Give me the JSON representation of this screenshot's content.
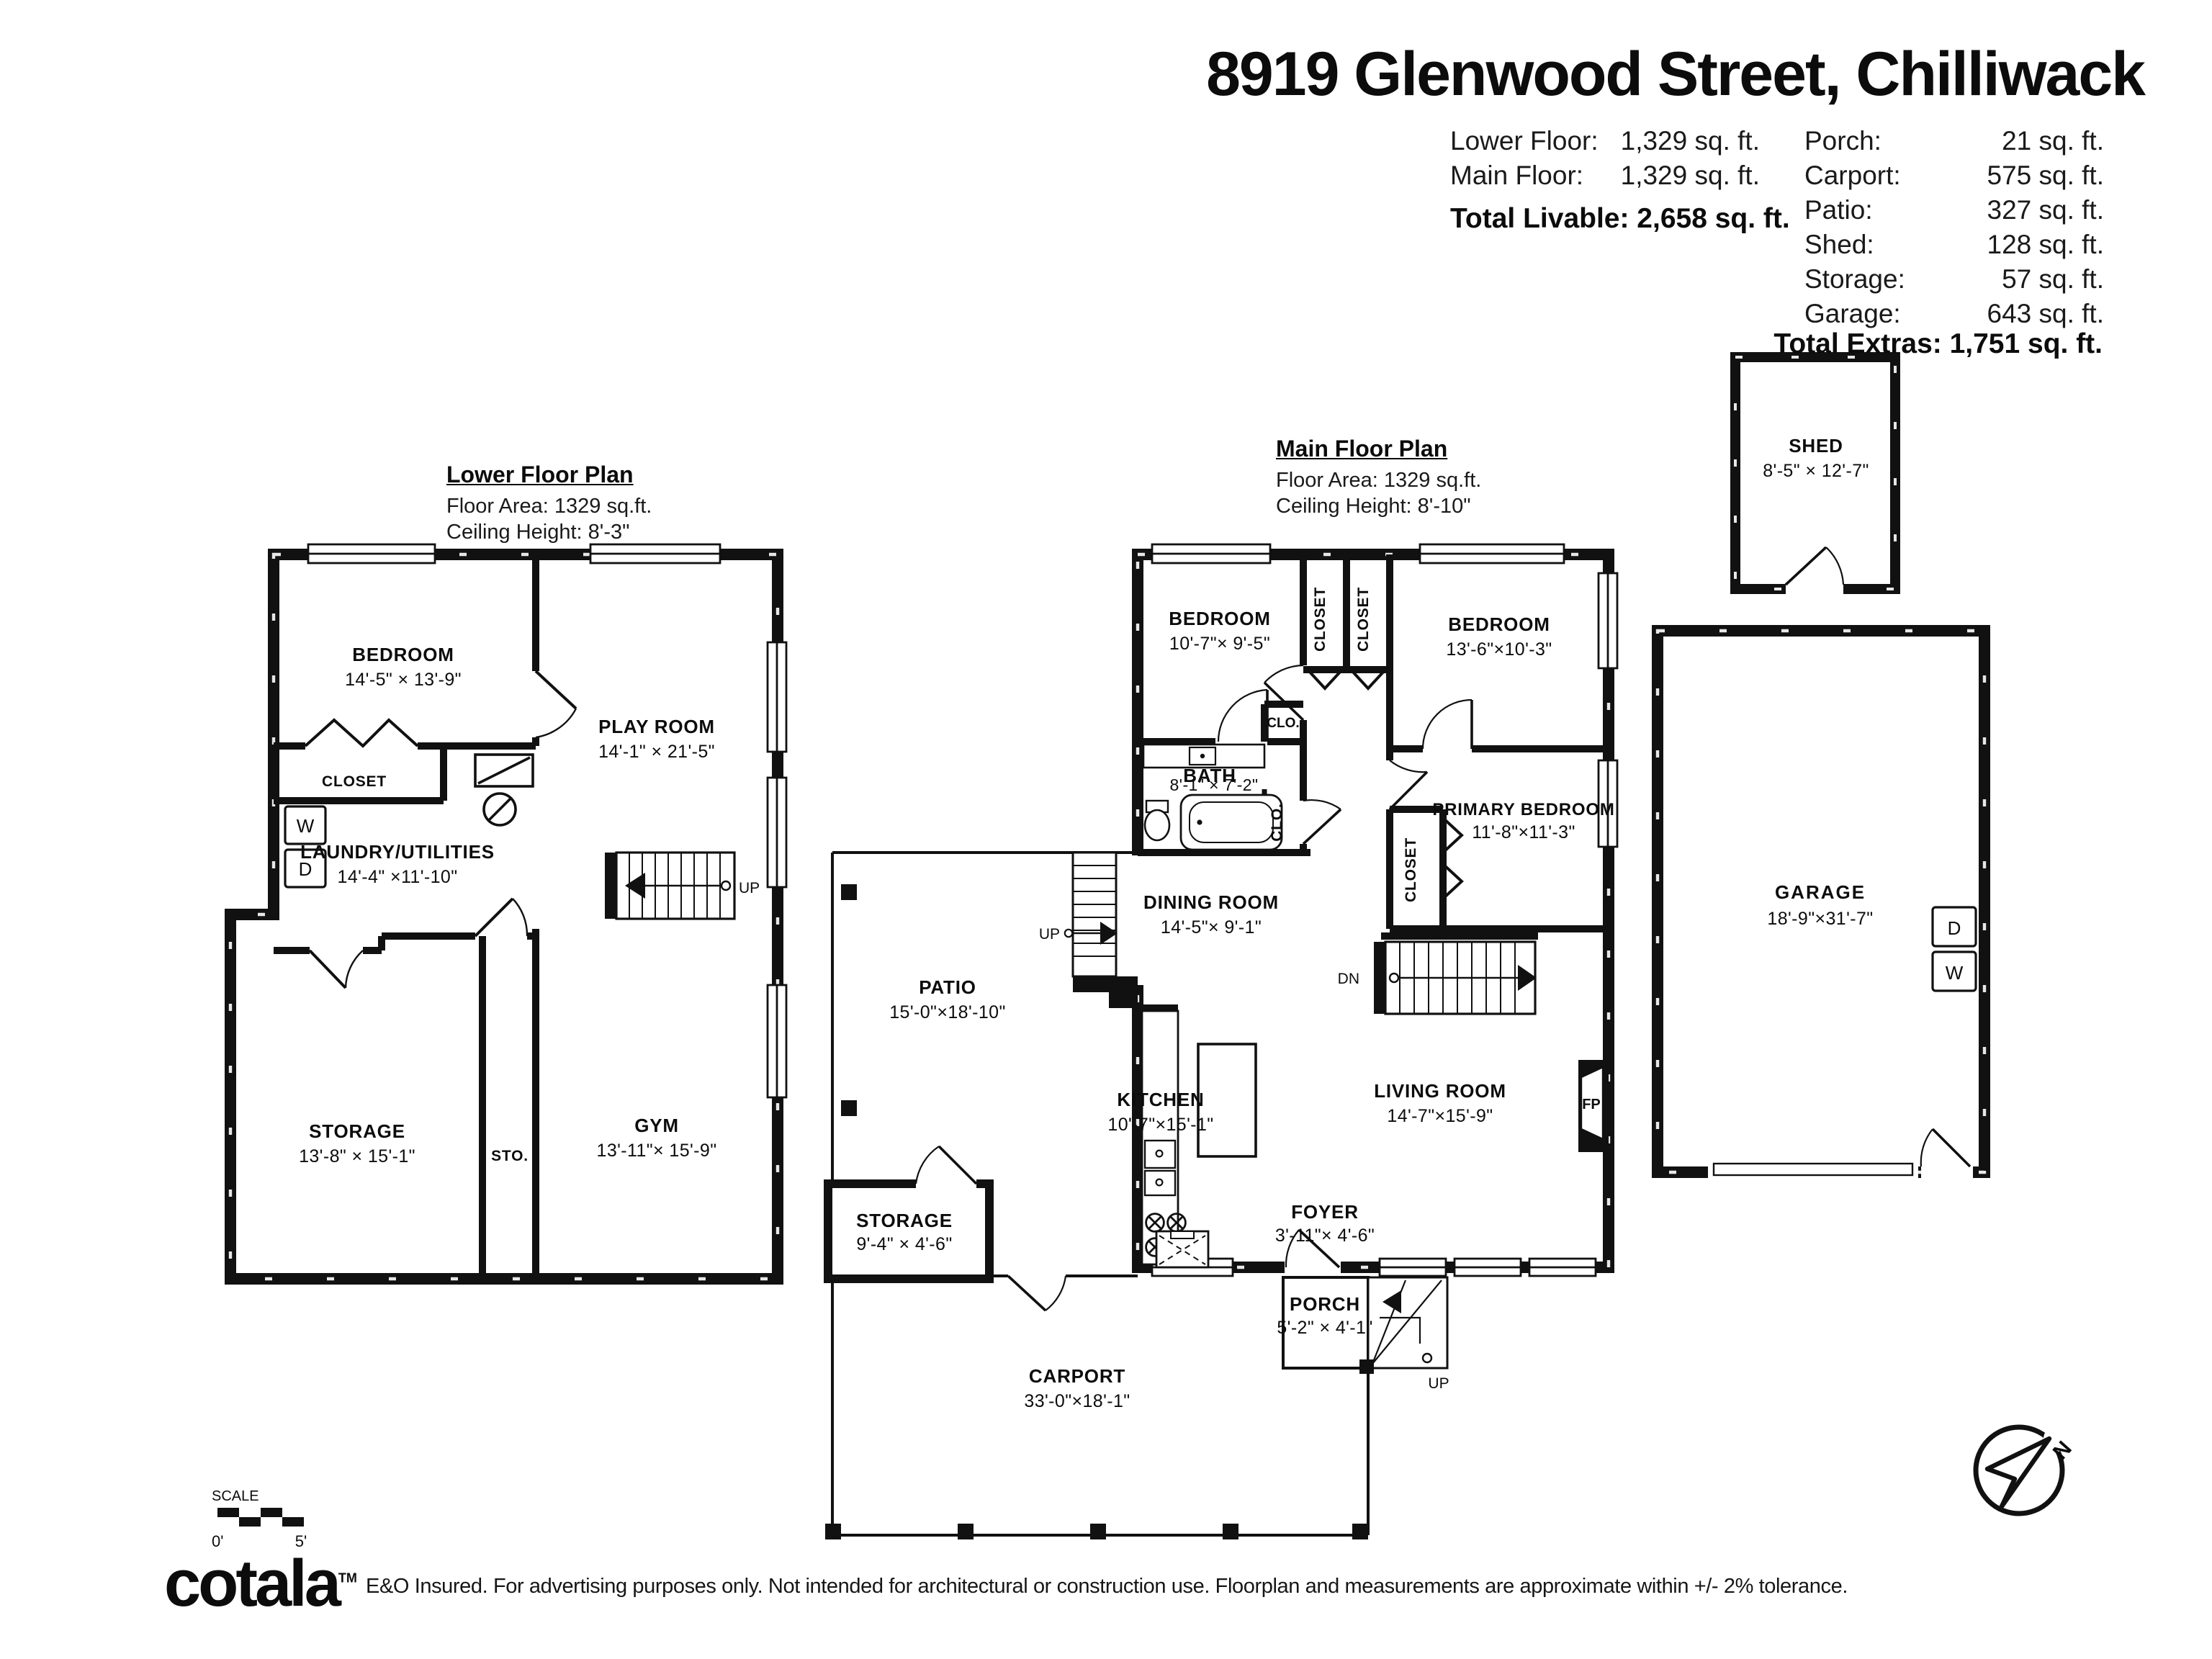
{
  "title": "8919 Glenwood Street, Chilliwack",
  "stats": {
    "left_rows": [
      {
        "label": "Lower Floor:",
        "value": "1,329 sq. ft."
      },
      {
        "label": "Main Floor:",
        "value": "1,329 sq. ft."
      }
    ],
    "total_livable": "Total Livable: 2,658 sq. ft.",
    "right_rows": [
      {
        "label": "Porch:",
        "value": "21 sq. ft."
      },
      {
        "label": "Carport:",
        "value": "575 sq. ft."
      },
      {
        "label": "Patio:",
        "value": "327 sq. ft."
      },
      {
        "label": "Shed:",
        "value": "128 sq. ft."
      },
      {
        "label": "Storage:",
        "value": "57 sq. ft."
      },
      {
        "label": "Garage:",
        "value": "643 sq. ft."
      }
    ],
    "total_extras": "Total Extras: 1,751 sq. ft."
  },
  "lower_plan": {
    "heading": "Lower Floor Plan",
    "floor_area": "Floor Area: 1329 sq.ft.",
    "ceiling_height": "Ceiling Height: 8'-3\"",
    "bedroom": {
      "name": "BEDROOM",
      "dims": "14'-5\" × 13'-9\""
    },
    "playroom": {
      "name": "PLAY ROOM",
      "dims": "14'-1\" × 21'-5\""
    },
    "closet": "CLOSET",
    "laundry": {
      "name": "LAUNDRY/UTILITIES",
      "dims": "14'-4\" ×11'-10\""
    },
    "storage": {
      "name": "STORAGE",
      "dims": "13'-8\" × 15'-1\""
    },
    "sto": "STO.",
    "gym": {
      "name": "GYM",
      "dims": "13'-11\"× 15'-9\""
    },
    "washer": "W",
    "dryer": "D",
    "up": "UP"
  },
  "main_plan": {
    "heading": "Main Floor Plan",
    "floor_area": "Floor Area: 1329 sq.ft.",
    "ceiling_height": "Ceiling Height: 8'-10\"",
    "bedroom1": {
      "name": "BEDROOM",
      "dims": "10'-7\"× 9'-5\""
    },
    "bedroom2": {
      "name": "BEDROOM",
      "dims": "13'-6\"×10'-3\""
    },
    "closet1": "CLOSET",
    "closet2": "CLOSET",
    "bath": {
      "name": "BATH",
      "dims": "8'-1\" × 7'-2\""
    },
    "clo1": "CLO.",
    "clo2": "CLO.",
    "primary": {
      "name": "PRIMARY BEDROOM",
      "dims": "11'-8\"×11'-3\""
    },
    "primary_closet": "CLOSET",
    "dining": {
      "name": "DINING ROOM",
      "dims": "14'-5\"× 9'-1\""
    },
    "patio": {
      "name": "PATIO",
      "dims": "15'-0\"×18'-10\""
    },
    "kitchen": {
      "name": "KITCHEN",
      "dims": "10'-7\"×15'-1\""
    },
    "living": {
      "name": "LIVING ROOM",
      "dims": "14'-7\"×15'-9\""
    },
    "storage": {
      "name": "STORAGE",
      "dims": "9'-4\" × 4'-6\""
    },
    "foyer": {
      "name": "FOYER",
      "dims": "3'-11\"× 4'-6\""
    },
    "porch": {
      "name": "PORCH",
      "dims": "5'-2\" × 4'-1\""
    },
    "carport": {
      "name": "CARPORT",
      "dims": "33'-0\"×18'-1\""
    },
    "fp": "FP",
    "dn": "DN",
    "up_patio": "UP",
    "up_porch": "UP"
  },
  "outbuildings": {
    "shed": {
      "name": "SHED",
      "dims": "8'-5\" × 12'-7\""
    },
    "garage": {
      "name": "GARAGE",
      "dims": "18'-9\"×31'-7\""
    },
    "dryer": "D",
    "washer": "W"
  },
  "scale_bar": {
    "label": "SCALE",
    "start": "0'",
    "end": "5'"
  },
  "compass": {
    "north": "N"
  },
  "footer": {
    "logo": "cotala",
    "tm": "TM",
    "disclaimer": "E&O Insured. For advertising purposes only. Not intended for architectural or construction use. Floorplan and measurements are approximate within +/- 2% tolerance."
  }
}
